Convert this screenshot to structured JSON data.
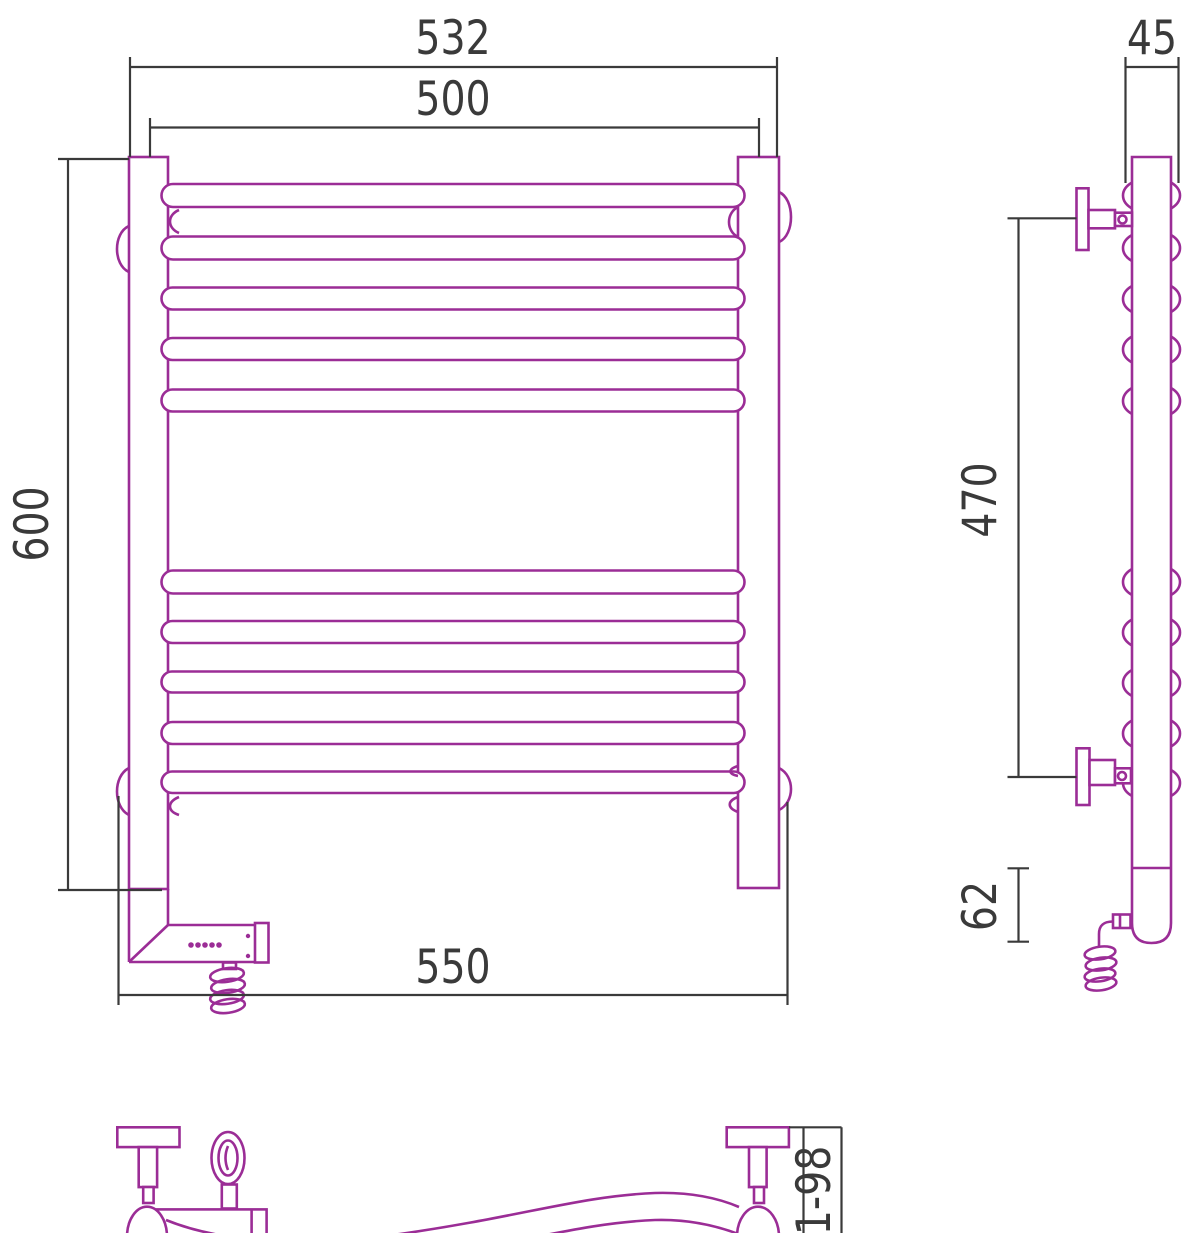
{
  "title": "Heated towel rail technical drawing",
  "colors": {
    "product_outline": "#9b2d96",
    "dimension_lines": "#3a3a3a",
    "background": "#ffffff"
  },
  "views": {
    "front": {
      "label": "front-view",
      "rail_count": 10,
      "dimensions": {
        "overall_width": "532",
        "pipe_centers_width": "500",
        "height": "600",
        "bottom_width": "550"
      }
    },
    "side": {
      "label": "side-view",
      "dimensions": {
        "depth": "45",
        "bracket_spacing": "470",
        "lower_offset": "62"
      }
    },
    "bottom": {
      "label": "bottom-view",
      "dimensions": {
        "wall_clearance": "81-98"
      }
    }
  }
}
